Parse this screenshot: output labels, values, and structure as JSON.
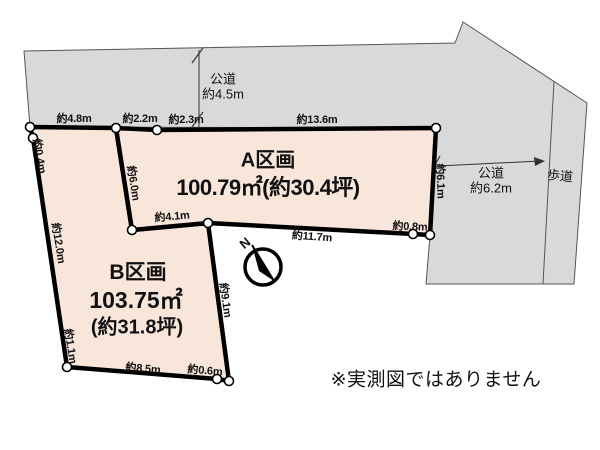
{
  "note": "※実測図ではありません",
  "compass": {
    "north_label": "N"
  },
  "plots": {
    "a": {
      "name": "A区画",
      "area": "100.79㎡(約30.4坪)"
    },
    "b": {
      "name": "B区画",
      "area_m2": "103.75㎡",
      "area_tsubo": "(約31.8坪)"
    }
  },
  "roads": {
    "top_name": "公道",
    "top_width": "約4.5m",
    "right_name": "公道",
    "right_width": "約6.2m",
    "sidewalk": "歩道"
  },
  "dims": {
    "d48": "約4.8m",
    "d22": "約2.2m",
    "d23": "約2.3m",
    "d136": "約13.6m",
    "d04": "約0.4m",
    "d60": "約6.0m",
    "d120": "約12.0m",
    "d11": "約1.1m",
    "d41": "約4.1m",
    "d91": "約9.1m",
    "d117": "約11.7m",
    "d08": "約0.8m",
    "d61": "約6.1m",
    "d85": "約8.5m",
    "d06": "約0.6m"
  },
  "colors": {
    "plot_fill": "#f8e6da",
    "road_fill": "#d9d9d9",
    "outline": "#000000"
  }
}
